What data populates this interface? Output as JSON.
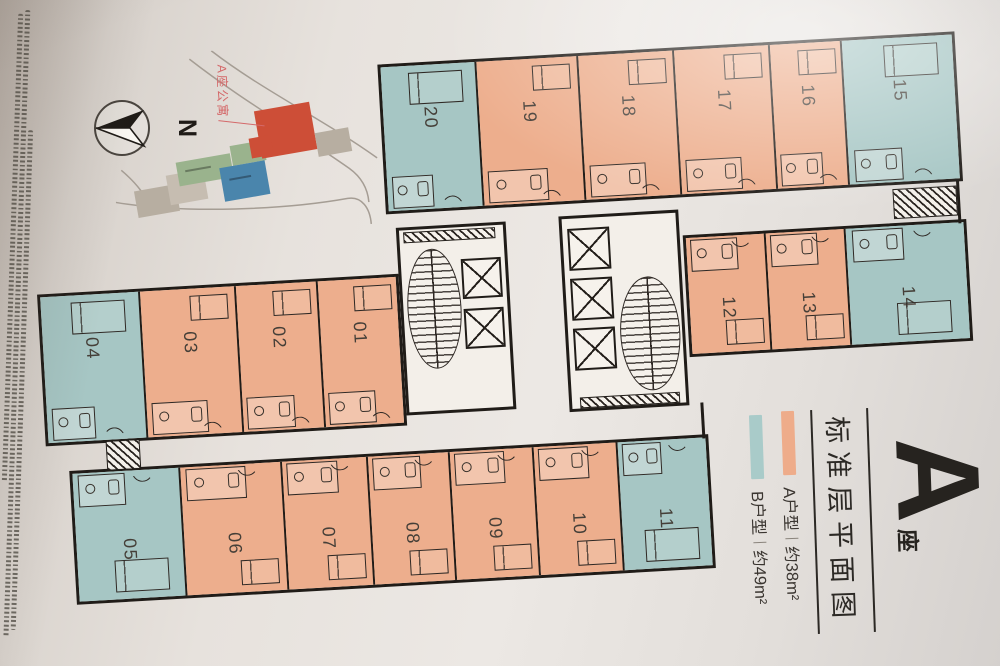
{
  "legend": {
    "block": {
      "letter": "A",
      "suffix": "座"
    },
    "plan_title": "标准层平面图",
    "items": [
      {
        "name": "A户型",
        "area": "约38m²",
        "swatch_color": "#eeac8a"
      },
      {
        "name": "B户型",
        "area": "约49m²",
        "swatch_color": "#a9cbc9"
      }
    ]
  },
  "compass": {
    "north_label": "N"
  },
  "site_plan": {
    "callout": "A座公寓",
    "highlight_color": "#cd4e37"
  },
  "plan": {
    "colors": {
      "type_a_fill": "#edae8d",
      "type_b_fill": "#a6c6c4",
      "wall": "#201c18"
    },
    "rows": {
      "top": [
        {
          "no": "20",
          "type": "B"
        },
        {
          "no": "19",
          "type": "A"
        },
        {
          "no": "18",
          "type": "A"
        },
        {
          "no": "17",
          "type": "A"
        },
        {
          "no": "16",
          "type": "A"
        },
        {
          "no": "15",
          "type": "B"
        }
      ],
      "upper_right": [
        {
          "no": "12",
          "type": "A"
        },
        {
          "no": "13",
          "type": "A"
        },
        {
          "no": "14",
          "type": "B"
        }
      ],
      "middle_left": [
        {
          "no": "04",
          "type": "B"
        },
        {
          "no": "03",
          "type": "A"
        },
        {
          "no": "02",
          "type": "A"
        },
        {
          "no": "01",
          "type": "A"
        }
      ],
      "bottom": [
        {
          "no": "05",
          "type": "B"
        },
        {
          "no": "06",
          "type": "A"
        },
        {
          "no": "07",
          "type": "A"
        },
        {
          "no": "08",
          "type": "A"
        },
        {
          "no": "09",
          "type": "A"
        },
        {
          "no": "10",
          "type": "A"
        },
        {
          "no": "11",
          "type": "B"
        }
      ]
    }
  }
}
